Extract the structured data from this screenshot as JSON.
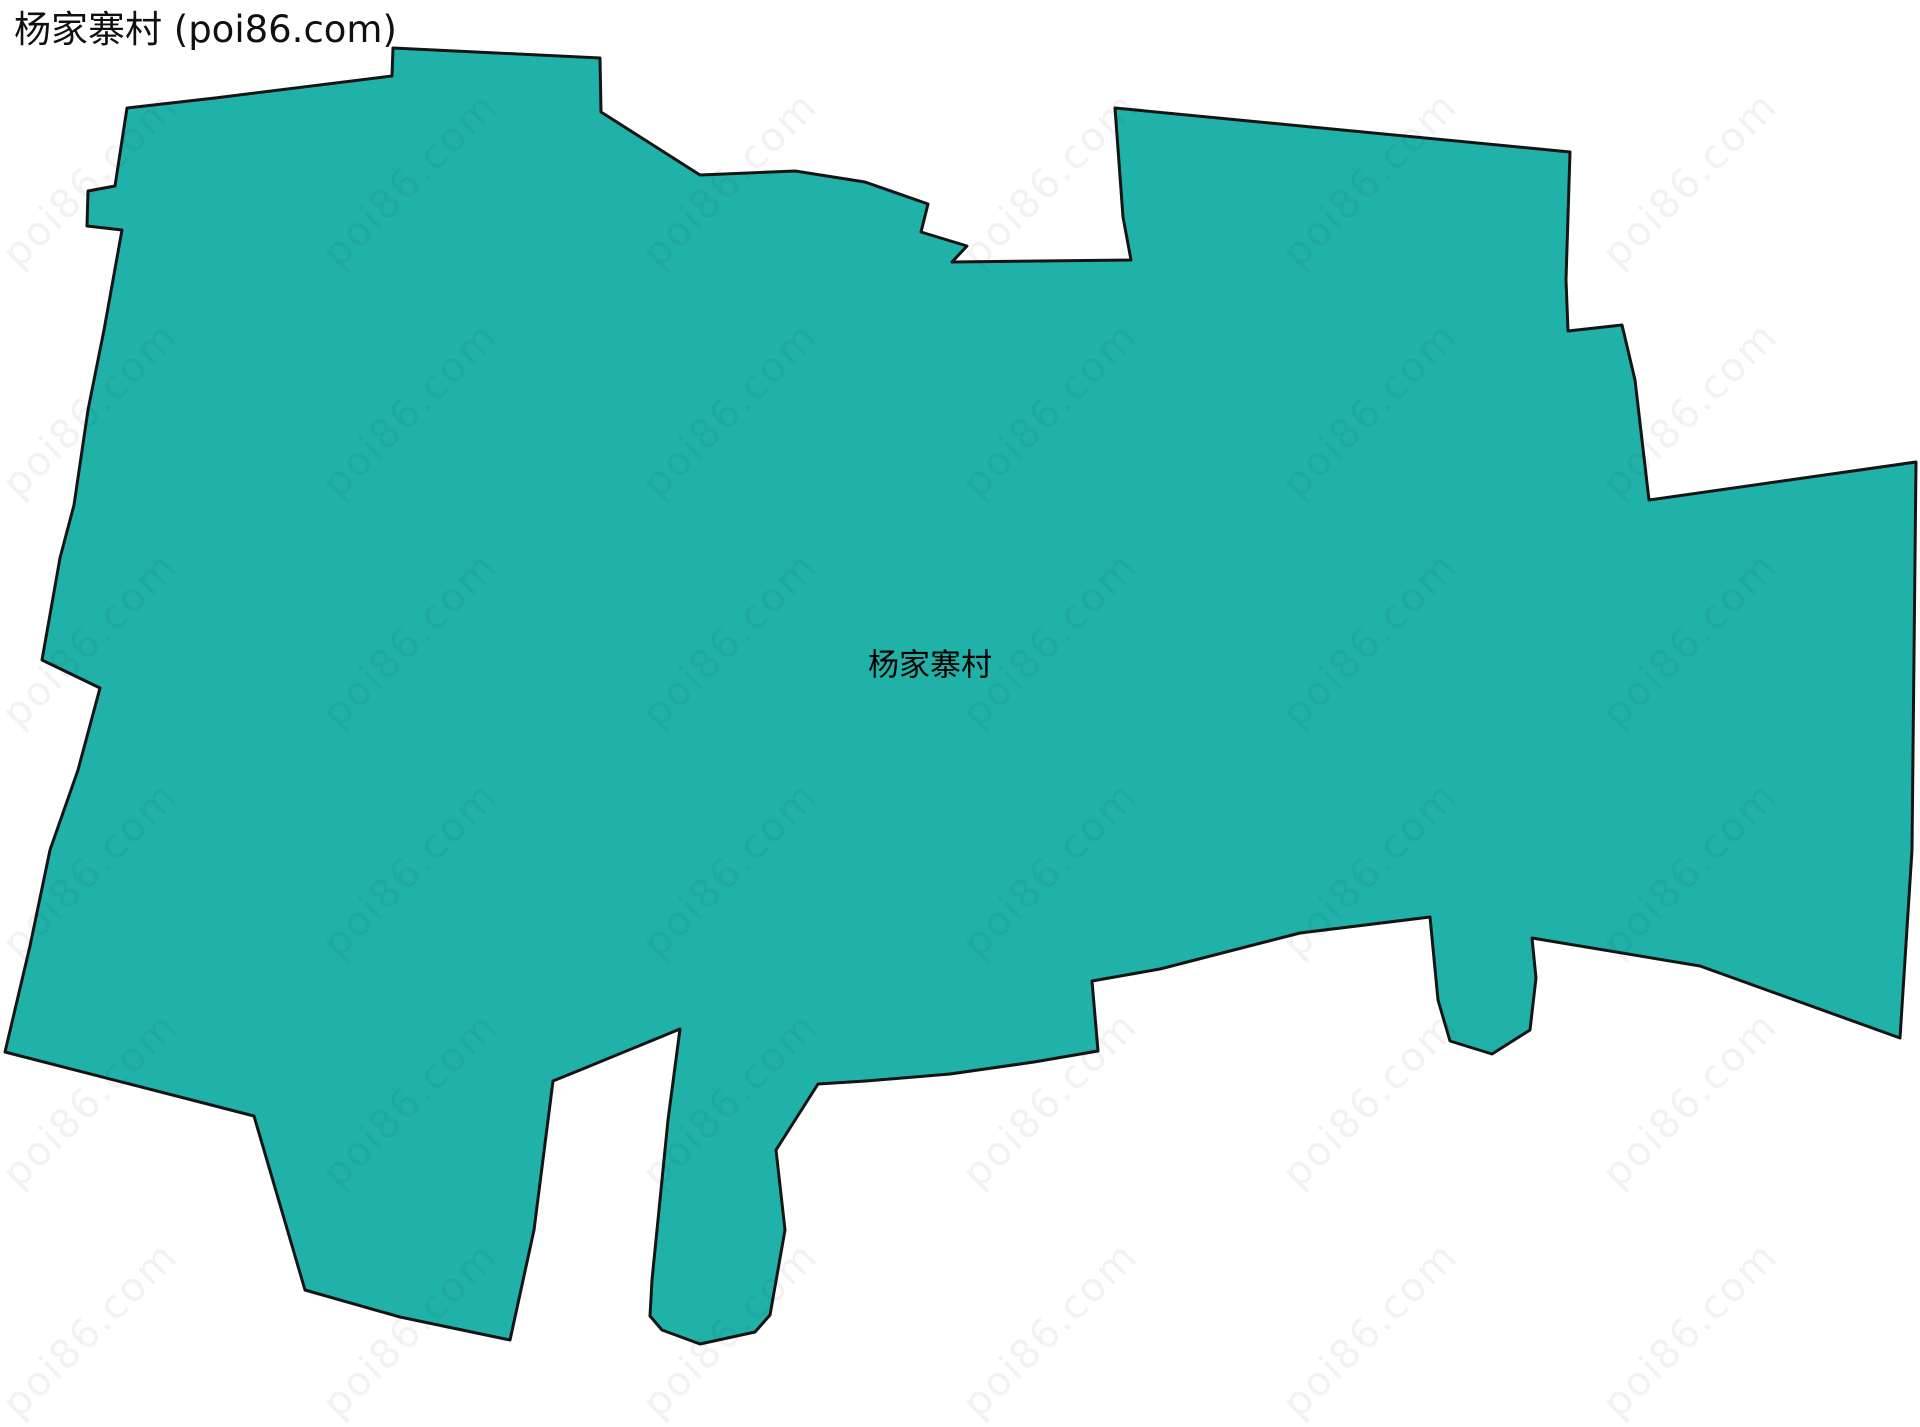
{
  "page": {
    "title": "杨家寨村 (poi86.com)",
    "background_color": "#ffffff"
  },
  "map": {
    "region_label": "杨家寨村",
    "label_x": 930,
    "label_y": 662,
    "fill_color": "#20b2a9",
    "stroke_color": "#141414",
    "stroke_width": 3,
    "polygon_points": [
      [
        392,
        76
      ],
      [
        393,
        48
      ],
      [
        600,
        58
      ],
      [
        601,
        112
      ],
      [
        700,
        175
      ],
      [
        795,
        171
      ],
      [
        865,
        182
      ],
      [
        928,
        204
      ],
      [
        921,
        232
      ],
      [
        967,
        246
      ],
      [
        952,
        262
      ],
      [
        1131,
        260
      ],
      [
        1123,
        217
      ],
      [
        1115,
        108
      ],
      [
        1570,
        152
      ],
      [
        1566,
        280
      ],
      [
        1568,
        331
      ],
      [
        1622,
        325
      ],
      [
        1635,
        380
      ],
      [
        1649,
        500
      ],
      [
        1916,
        462
      ],
      [
        1912,
        850
      ],
      [
        1900,
        1038
      ],
      [
        1700,
        966
      ],
      [
        1532,
        938
      ],
      [
        1536,
        978
      ],
      [
        1530,
        1030
      ],
      [
        1492,
        1054
      ],
      [
        1450,
        1041
      ],
      [
        1438,
        1000
      ],
      [
        1430,
        917
      ],
      [
        1300,
        933
      ],
      [
        1160,
        969
      ],
      [
        1092,
        981
      ],
      [
        1098,
        1051
      ],
      [
        1034,
        1062
      ],
      [
        950,
        1074
      ],
      [
        866,
        1081
      ],
      [
        818,
        1084
      ],
      [
        776,
        1150
      ],
      [
        785,
        1230
      ],
      [
        770,
        1315
      ],
      [
        755,
        1332
      ],
      [
        700,
        1344
      ],
      [
        662,
        1330
      ],
      [
        650,
        1316
      ],
      [
        652,
        1280
      ],
      [
        668,
        1120
      ],
      [
        680,
        1029
      ],
      [
        585,
        1068
      ],
      [
        553,
        1081
      ],
      [
        534,
        1230
      ],
      [
        510,
        1340
      ],
      [
        400,
        1317
      ],
      [
        305,
        1290
      ],
      [
        254,
        1116
      ],
      [
        5,
        1052
      ],
      [
        30,
        946
      ],
      [
        50,
        850
      ],
      [
        78,
        770
      ],
      [
        100,
        688
      ],
      [
        42,
        660
      ],
      [
        60,
        558
      ],
      [
        74,
        505
      ],
      [
        88,
        410
      ],
      [
        104,
        330
      ],
      [
        122,
        230
      ],
      [
        87,
        226
      ],
      [
        88,
        191
      ],
      [
        115,
        186
      ],
      [
        127,
        108
      ],
      [
        215,
        98
      ]
    ]
  },
  "watermark": {
    "text": "poi86.com",
    "color": "rgba(20,20,20,0.055)",
    "font_size": 40,
    "rotation_deg": -45,
    "grid": {
      "start_x": 90,
      "start_y": 180,
      "step_x": 320,
      "step_y": 230,
      "cols": 6,
      "rows": 6
    }
  }
}
